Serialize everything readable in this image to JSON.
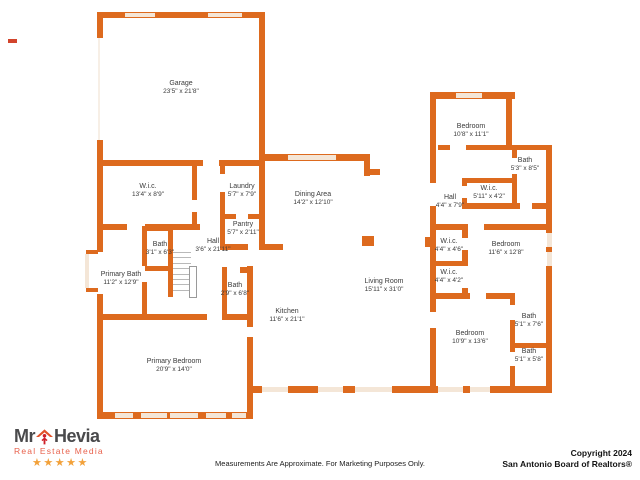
{
  "plan": {
    "rooms": [
      {
        "name": "Garage",
        "dims": "23'5\" x 21'8\"",
        "x": 181,
        "y": 80
      },
      {
        "name": "W.i.c.",
        "dims": "13'4\" x 8'9\"",
        "x": 148,
        "y": 183
      },
      {
        "name": "Laundry",
        "dims": "5'7\" x 7'9\"",
        "x": 242,
        "y": 183
      },
      {
        "name": "Pantry",
        "dims": "5'7\" x 2'11\"",
        "x": 243,
        "y": 221
      },
      {
        "name": "Bath",
        "dims": "3'1\" x 6'3\"",
        "x": 160,
        "y": 241
      },
      {
        "name": "Hall",
        "dims": "3'6\" x 21'11\"",
        "x": 213,
        "y": 238
      },
      {
        "name": "Primary Bath",
        "dims": "11'2\" x 12'9\"",
        "x": 121,
        "y": 271
      },
      {
        "name": "Bath",
        "dims": "2'9\" x 6'8\"",
        "x": 235,
        "y": 282
      },
      {
        "name": "Primary Bedroom",
        "dims": "20'9\" x 14'0\"",
        "x": 174,
        "y": 358
      },
      {
        "name": "Dining Area",
        "dims": "14'2\" x 12'10\"",
        "x": 313,
        "y": 191
      },
      {
        "name": "Kitchen",
        "dims": "11'6\" x 21'1\"",
        "x": 287,
        "y": 308
      },
      {
        "name": "Living Room",
        "dims": "15'11\" x 31'0\"",
        "x": 384,
        "y": 278
      },
      {
        "name": "Bedroom",
        "dims": "10'8\" x 11'1\"",
        "x": 471,
        "y": 123
      },
      {
        "name": "Bath",
        "dims": "5'3\" x 8'5\"",
        "x": 525,
        "y": 157
      },
      {
        "name": "W.i.c.",
        "dims": "5'11\" x 4'2\"",
        "x": 489,
        "y": 185
      },
      {
        "name": "Hall",
        "dims": "4'4\" x 7'9\"",
        "x": 450,
        "y": 194
      },
      {
        "name": "W.i.c.",
        "dims": "4'4\" x 4'6\"",
        "x": 449,
        "y": 238
      },
      {
        "name": "Bedroom",
        "dims": "11'6\" x 12'8\"",
        "x": 506,
        "y": 241
      },
      {
        "name": "W.i.c.",
        "dims": "4'4\" x 4'2\"",
        "x": 449,
        "y": 269
      },
      {
        "name": "Bedroom",
        "dims": "10'9\" x 13'6\"",
        "x": 470,
        "y": 330
      },
      {
        "name": "Bath",
        "dims": "5'1\" x 7'6\"",
        "x": 529,
        "y": 313
      },
      {
        "name": "Bath",
        "dims": "5'1\" x 5'8\"",
        "x": 529,
        "y": 348
      }
    ]
  },
  "footer": {
    "disclaimer": "Measurements Are Approximate. For Marketing Purposes Only.",
    "copyright_line1": "Copyright 2024",
    "copyright_line2": "San Antonio Board of Realtors®"
  },
  "logo": {
    "brand_prefix": "Mr",
    "brand_suffix": "Hevia",
    "tagline": "Real Estate Media",
    "stars": "★★★★★"
  },
  "colors": {
    "wall": "#DD6A1E",
    "window": "#F4E6D7",
    "label_text": "#3a3a3a",
    "logo_gray": "#4a4a4c",
    "logo_red": "#e8614c",
    "star_orange": "#f2a13a"
  }
}
